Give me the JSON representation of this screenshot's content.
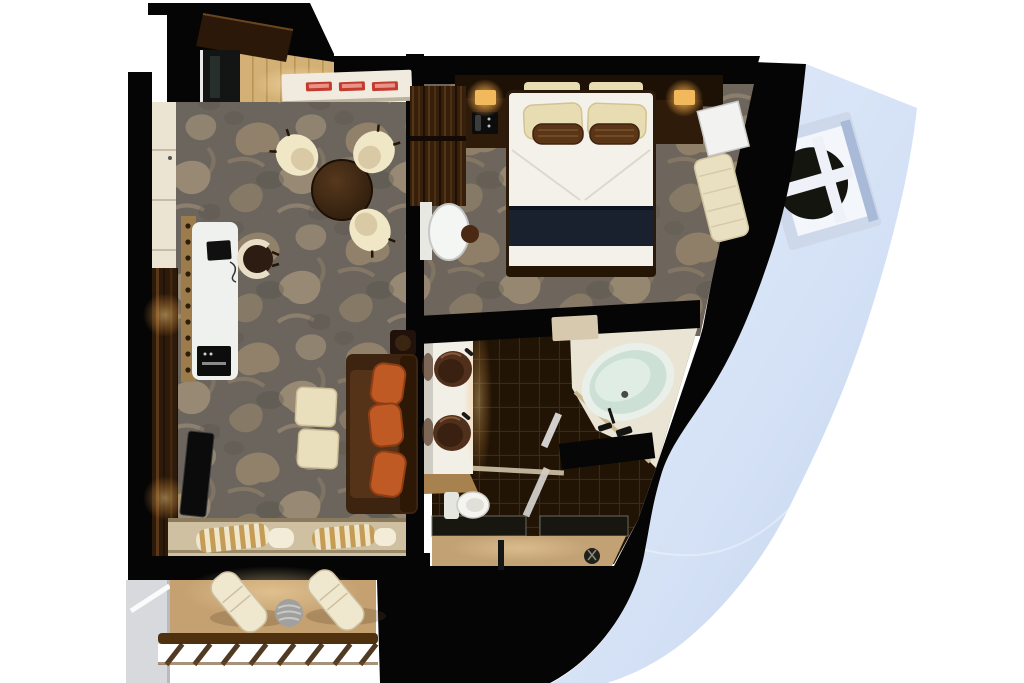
{
  "canvas": {
    "width": 1024,
    "height": 683,
    "background": "#ffffff"
  },
  "scene": {
    "kind": "3d-floor-plan-render",
    "subject": "cruise-ship-suite-top-view",
    "has_text": false
  },
  "colors": {
    "background": "#ffffff",
    "wall": "#050505",
    "hull": "#d5e2f6",
    "hull_edge": "#bccdea",
    "porthole_frame": "#cdd8eb",
    "porthole_inner": "#f3f6fb",
    "porthole_glass": "#15150f",
    "carpet_base": "#6b655d",
    "carpet_accent": "#9d8a6f",
    "carpet_accent_light": "#b5a183",
    "entry_floor": "#d3b176",
    "entry_door": "#2b1808",
    "closet_mirror": "#121513",
    "closet_cream": "#ece4d3",
    "wood_wall": "#2c1a0a",
    "counter_cream": "#f1ebdf",
    "tray_red": "#c33b2c",
    "table_brown": "#2f1d0d",
    "chair_cream": "#f0e7c6",
    "chair_seat": "#d9c9a4",
    "desk_white": "#eef1ee",
    "laptop_black": "#101010",
    "printer_black": "#0d0d0d",
    "tv_black": "#0b0b0b",
    "sofa_brown": "#3c2410",
    "sofa_seat": "#553318",
    "pillow_orange": "#c05a24",
    "ottoman_cream": "#eadfbd",
    "side_table": "#20110a",
    "window_sill": "#cfc0a2",
    "curtain_gold": "#c59c55",
    "curtain_cream": "#efe6cc",
    "balcony_floor": "#c5a171",
    "rail_wood": "#4f300f",
    "partition_gray": "#d7d9dc",
    "lounger_cream": "#efe8cf",
    "balcony_table": "#a0a09e",
    "bed_white": "#f3f1ea",
    "bed_runner": "#19212f",
    "bed_frame": "#2b1b0c",
    "pillow_cream": "#e8ddb2",
    "bolster_brown": "#5a3516",
    "headboard": "#1d1105",
    "nightstand": "#2e1b09",
    "lamp_glow": "#f2b95c",
    "dresser_wood": "#36200c",
    "mirror_white": "#f4f6f4",
    "stool_brown": "#4a2a12",
    "cabinet_white": "#f2f3f1",
    "chaise_cream": "#e9e0c2",
    "bath_floor": "#221405",
    "tile_line": "#3a2a18",
    "vanity_white": "#f2efe6",
    "sink_brown": "#50301c",
    "tub_rim": "#e9efe9",
    "tub_water": "#cde0d6",
    "toilet_white": "#f4f4f0",
    "shower_floor": "#c2a275",
    "mat_black": "#060606"
  },
  "rooms": {
    "entry": {
      "name": "entry-vestibule",
      "items": [
        "entry-door",
        "mirror-closet",
        "wood-floor"
      ]
    },
    "living_room": {
      "name": "living-room",
      "items": [
        "dining-table",
        "three-dining-chairs",
        "console-counter",
        "three-red-trays",
        "wardrobe-closet",
        "writing-desk",
        "laptop",
        "desk-chair",
        "printer",
        "tv-panel",
        "sofa",
        "three-orange-cushions",
        "two-ottomans",
        "side-table",
        "curtains",
        "sliding-door-sill"
      ]
    },
    "bedroom": {
      "name": "bedroom",
      "items": [
        "king-bed",
        "navy-runner",
        "cream-pillows",
        "woven-bolsters",
        "headboard-console",
        "two-lamps",
        "two-nightstands",
        "telephone",
        "dresser",
        "vanity-mirror",
        "stool",
        "white-cabinet",
        "chaise-longue"
      ]
    },
    "bathroom": {
      "name": "bathroom",
      "items": [
        "double-vanity",
        "two-vessel-sinks",
        "mirror-strip",
        "oval-bathtub",
        "tub-faucet",
        "black-mat",
        "glass-partitions",
        "shower-floor",
        "shower-fixtures",
        "toilet",
        "door-threshold"
      ]
    },
    "balcony": {
      "name": "balcony",
      "items": [
        "privacy-partition",
        "two-loungers",
        "round-table",
        "railing"
      ]
    },
    "exterior": {
      "name": "ship-hull",
      "items": [
        "hull-plating",
        "porthole-window",
        "hull-crease"
      ]
    }
  }
}
